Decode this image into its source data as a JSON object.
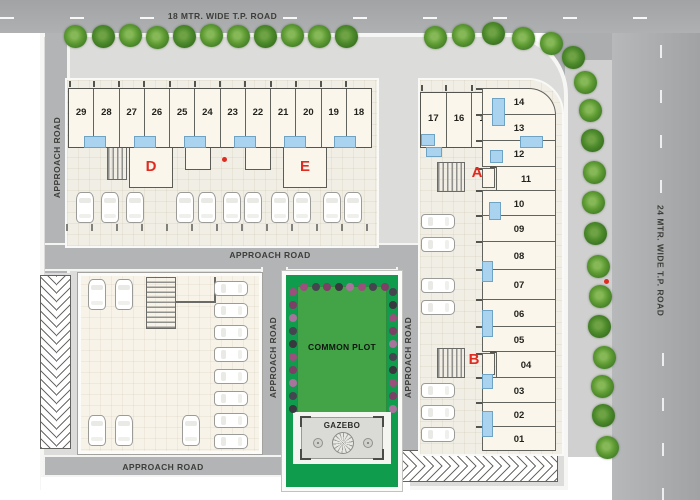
{
  "site": {
    "tp_road_top_label": "18 MTR. WIDE T.P. ROAD",
    "tp_road_right_label": "24 MTR. WIDE T.P. ROAD",
    "approach_road_label": "APPROACH ROAD",
    "common_plot_label": "COMMON PLOT",
    "gazebo_label": "GAZEBO"
  },
  "blocks": {
    "de_units": [
      "29",
      "28",
      "27",
      "26",
      "25",
      "24",
      "23",
      "22",
      "21",
      "20",
      "19",
      "18"
    ],
    "de_wing_labels": [
      "D",
      "E"
    ],
    "a_label": "A",
    "b_label": "B",
    "a_top_units": [
      "17",
      "16",
      "15"
    ],
    "column_units": [
      "14",
      "13",
      "12",
      "11",
      "10",
      "09",
      "08",
      "07",
      "06",
      "05",
      "04",
      "03",
      "02",
      "01"
    ]
  },
  "colors": {
    "road_gray": "#a8aaac",
    "approach_road_gray": "#b2b4b6",
    "building_cream": "#faf6ec",
    "balcony_blue": "#a9d3ee",
    "lawn_green": "#42a446",
    "frame_green": "#0f9c4c",
    "accent_red": "#e02b20",
    "tree_green": "#5f9c33",
    "flower_purple": "#9a4f7d"
  },
  "icons": {
    "tree": "tree-icon",
    "car": "car-icon",
    "flower": "flower-icon",
    "staircase": "staircase-icon",
    "gazebo_rosette": "gazebo-dome-icon",
    "red_dot": "red-dot-marker",
    "chevron_hatch": "chevron-hatch-icon"
  }
}
